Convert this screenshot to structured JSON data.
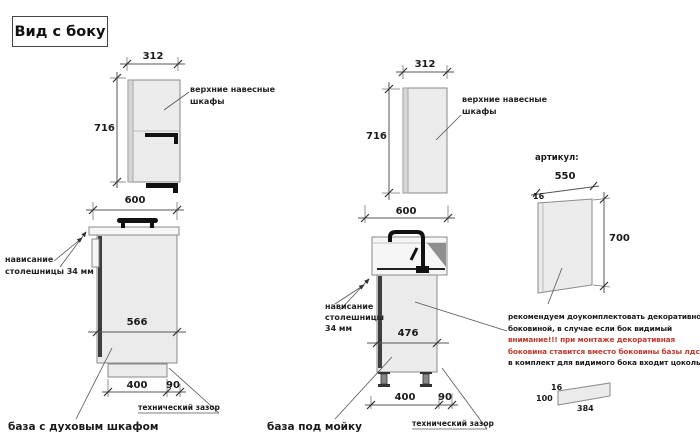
{
  "title": "Вид с боку",
  "colors": {
    "warning_red": "#c0392b",
    "outline_gray": "#8a8a8a",
    "cabinet_fill": "#ebebeb",
    "black": "#111111"
  },
  "oven_base": {
    "upper_width": "312",
    "upper_height": "716",
    "upper_label_line1": "верхние навесные",
    "upper_label_line2": "шкафы",
    "base_width": "600",
    "overhang_line1": "нависание",
    "overhang_line2": "столешницы 34 мм",
    "inner_width": "566",
    "plinth_width": "400",
    "gap_width": "90",
    "gap_label": "технический зазор",
    "caption": "база с духовым шкафом"
  },
  "sink_base": {
    "upper_width": "312",
    "upper_height": "716",
    "upper_label_line1": "верхние навесные",
    "upper_label_line2": "шкафы",
    "base_width": "600",
    "overhang_line1": "нависание",
    "overhang_line2": "столешницы",
    "overhang_line3": "34 мм",
    "inner_width": "476",
    "plinth_width": "400",
    "gap_width": "90",
    "gap_label": "технический зазор",
    "caption": "база под мойку"
  },
  "side_panel": {
    "heading": "артикул:",
    "width": "550",
    "thickness": "16",
    "height": "700",
    "note_line1": "рекомендуем доукомплектовать декоративной",
    "note_line2": "боковиной, в случае если бок видимый",
    "note_line3": "внимание!!! при монтаже декоративная",
    "note_line4": "боковина ставится вместо боковины базы лдсп",
    "note_line5": "в комплект для видимого бока входит цоколь:",
    "plinth_thickness": "16",
    "plinth_height": "100",
    "plinth_length": "384"
  }
}
